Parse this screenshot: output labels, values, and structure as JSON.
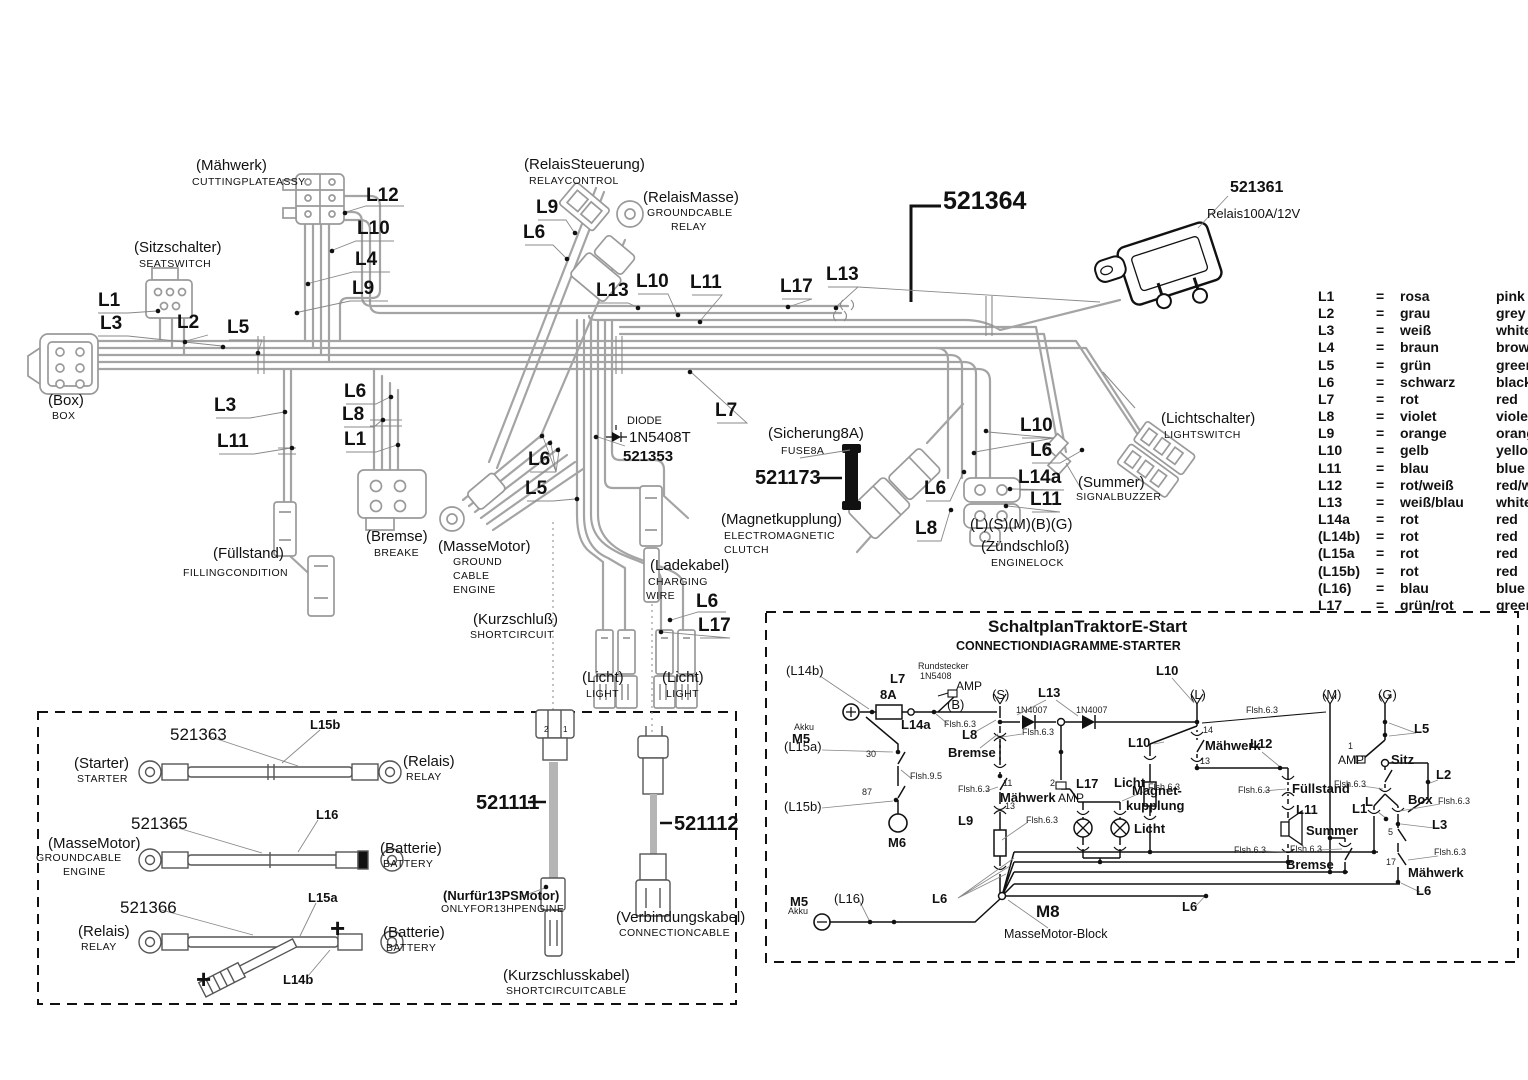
{
  "h": {
    "maehwerk_de": "(Mähwerk)",
    "maehwerk_en": "CUTTINGPLATEASSY",
    "l12": "L12",
    "l10a": "L10",
    "l4": "L4",
    "l9a": "L9",
    "sitz_de": "(Sitzschalter)",
    "sitz_en": "SEATSWITCH",
    "l1a": "L1",
    "l3a": "L3",
    "l2": "L2",
    "l5a": "L5",
    "box_de": "(Box)",
    "box_en": "BOX",
    "l3b": "L3",
    "l11a": "L11",
    "l6a": "L6",
    "l8a": "L8",
    "l1b": "L1",
    "fuell_de": "(Füllstand)",
    "fuell_en": "FILLINGCONDITION",
    "bremse_de": "(Bremse)",
    "bremse_en": "BREAKE",
    "masse_de": "(MasseMotor)",
    "masse_en1": "GROUND",
    "masse_en2": "CABLE",
    "masse_en3": "ENGINE",
    "kurz_de": "(Kurzschluß)",
    "kurz_en": "SHORTCIRCUIT",
    "relst_de": "(RelaisSteuerung)",
    "relst_en": "RELAYCONTROL",
    "l9b": "L9",
    "l6b": "L6",
    "relma_de": "(RelaisMasse)",
    "relma_en1": "GROUNDCABLE",
    "relma_en2": "RELAY",
    "l13a": "L13",
    "l10b": "L10",
    "l11b": "L11",
    "l17a": "L17",
    "l13b": "L13",
    "l7": "L7",
    "diode1": "DIODE",
    "diode2": "1N5408T",
    "diode3": "521353",
    "l6c": "L6",
    "l5b": "L5",
    "sich_de": "(Sicherung8A)",
    "sich_en": "FUSE8A",
    "p173": "521173",
    "mag_de": "(Magnetkupplung)",
    "mag_en1": "ELECTROMAGNETIC",
    "mag_en2": "CLUTCH",
    "lade_de": "(Ladekabel)",
    "lade_en1": "CHARGING",
    "lade_en2": "WIRE",
    "l6d": "L6",
    "l17b": "L17",
    "licht1_de": "(Licht)",
    "licht1_en": "LIGHT",
    "licht2_de": "(Licht)",
    "licht2_en": "LIGHT",
    "p364": "521364",
    "p361": "521361",
    "relais_spec": "Relais100A/12V",
    "lichts_de": "(Lichtschalter)",
    "lichts_en": "LIGHTSWITCH",
    "l10c": "L10",
    "l6e": "L6",
    "l14a": "L14a",
    "l11c": "L11",
    "l6f": "L6",
    "l8b": "L8",
    "summer_de": "(Summer)",
    "summer_en": "SIGNALBUZZER",
    "lsmbg": "(L)(S)(M)(B)(G)",
    "zuend_de": "(Zündschloß)",
    "zuend_en": "ENGINELOCK"
  },
  "c": {
    "p363": "521363",
    "l15b": "L15b",
    "starter_de": "(Starter)",
    "starter_en": "STARTER",
    "relais1_de": "(Relais)",
    "relais1_en": "RELAY",
    "p365": "521365",
    "l16": "L16",
    "masse_de": "(MasseMotor)",
    "masse_en1": "GROUNDCABLE",
    "masse_en2": "ENGINE",
    "batt1_de": "(Batterie)",
    "batt1_en": "BATTERY",
    "p366": "521366",
    "l15a": "L15a",
    "relais2_de": "(Relais)",
    "relais2_en": "RELAY",
    "batt2_de": "(Batterie)",
    "batt2_en": "BATTERY",
    "l14b": "L14b",
    "plus": "+",
    "p111": "521111",
    "nur_de": "(Nurfür13PSMotor)",
    "nur_en": "ONLYFOR13HPENGINE",
    "kurzk_de": "(Kurzschlusskabel)",
    "kurzk_en": "SHORTCIRCUITCABLE",
    "p112": "521112",
    "verb_de": "(Verbindungskabel)",
    "verb_en": "CONNECTIONCABLE",
    "pin1": "1",
    "pin2": "2"
  },
  "s": {
    "title_de": "SchaltplanTraktorE-Start",
    "title_en": "CONNECTIONDIAGRAMME-STARTER",
    "l14b": "(L14b)",
    "akku": "Akku",
    "m5a": "M5",
    "l7": "L7",
    "f8a": "8A",
    "rund1": "Rundstecker",
    "rund2": "1N5408",
    "amp1": "AMP",
    "b": "(B)",
    "l14a": "L14a",
    "f631": "Flsh.6.3",
    "sx": "(S)",
    "l13": "L13",
    "d1": "1N4007",
    "d2": "1N4007",
    "l8": "L8",
    "bremse1": "Bremse",
    "f632": "Flsh.6.3",
    "l15a": "(L15a)",
    "n30": "30",
    "f95": "Flsh.9.5",
    "n87": "87",
    "l15b": "(L15b)",
    "m6": "M6",
    "l10a": "L10",
    "l10b": "L10",
    "lx": "(L)",
    "f633": "Flsh.6.3",
    "mx": "(M)",
    "gx": "(G)",
    "n14": "14",
    "maeh1": "Mähwerk",
    "l12": "L12",
    "n13a": "13",
    "f634": "Flsh.6.3",
    "n11": "11",
    "maeh2": "Mähwerk",
    "amp2": "AMP",
    "n2": "2",
    "l17": "L17",
    "licht1": "Licht",
    "f635": "Flsh.6.3",
    "l9": "L9",
    "n13b": "13",
    "f636": "Flsh.6.3",
    "licht2": "Licht",
    "mag1": "Magnet-",
    "mag2": "kupplung",
    "fuell": "Füllstand",
    "f637": "Flsh.6.3",
    "l11": "L11",
    "summer": "Summer",
    "f638": "Flsh.6.3",
    "l1": "L1",
    "n1": "1",
    "amp3": "AMP",
    "sitz": "Sitz",
    "l5": "L5",
    "l2": "L2",
    "f639": "Flsh.6.3",
    "lb": "L",
    "box": "Box",
    "f6310": "Flsh.6.3",
    "l3": "L3",
    "n5": "5",
    "n17": "17",
    "maeh3": "Mähwerk",
    "f6311": "Flsh.6.3",
    "bremse2": "Bremse",
    "f6312": "Flsh.6.3",
    "l6a": "L6",
    "l6b": "L6",
    "l6c": "L6",
    "l16": "(L16)",
    "m5b": "M5",
    "akku2": "Akku",
    "m8": "M8",
    "mmblock": "MasseMotor-Block"
  },
  "lg": {
    "eq": "=",
    "rows": [
      {
        "c": "L1",
        "de": "rosa",
        "en": "pink"
      },
      {
        "c": "L2",
        "de": "grau",
        "en": "grey"
      },
      {
        "c": "L3",
        "de": "weiß",
        "en": "white"
      },
      {
        "c": "L4",
        "de": "braun",
        "en": "brown"
      },
      {
        "c": "L5",
        "de": "grün",
        "en": "green"
      },
      {
        "c": "L6",
        "de": "schwarz",
        "en": "black"
      },
      {
        "c": "L7",
        "de": "rot",
        "en": "red"
      },
      {
        "c": "L8",
        "de": "violet",
        "en": "violet"
      },
      {
        "c": "L9",
        "de": "orange",
        "en": "orange"
      },
      {
        "c": "L10",
        "de": "gelb",
        "en": "yellow"
      },
      {
        "c": "L11",
        "de": "blau",
        "en": "blue"
      },
      {
        "c": "L12",
        "de": "rot/weiß",
        "en": "red/white"
      },
      {
        "c": "L13",
        "de": "weiß/blau",
        "en": "white/blue"
      },
      {
        "c": "L14a",
        "de": "rot",
        "en": "red"
      },
      {
        "c": "(L14b)",
        "de": "rot",
        "en": "red"
      },
      {
        "c": "(L15a",
        "de": "rot",
        "en": "red"
      },
      {
        "c": "(L15b)",
        "de": "rot",
        "en": "red"
      },
      {
        "c": "(L16)",
        "de": "blau",
        "en": "blue"
      },
      {
        "c": "L17",
        "de": "grün/rot",
        "en": "green/red"
      }
    ]
  }
}
